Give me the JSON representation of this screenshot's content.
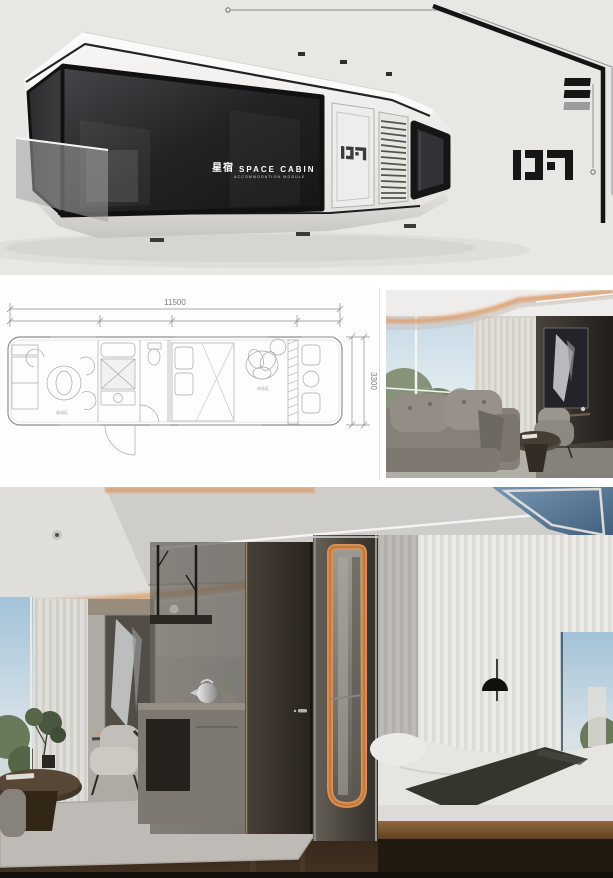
{
  "hero": {
    "bg_color": "#e9e7e4",
    "brand_cn": "星宿",
    "brand_en": "SPACE CABIN",
    "brand_sub": "ACCOMMODATION MODULE",
    "door_label": "D7",
    "corner_label": "D7"
  },
  "floor_plan": {
    "total_width": "11500",
    "depth": "3300",
    "zone_labels": [
      "休闲区",
      "休息区"
    ]
  },
  "colors": {
    "line_art": "#9a9a9a",
    "ink": "#161616",
    "warm_glow": "#e2a470",
    "copper_trim": "#c8803f",
    "sky": "#a8c8df",
    "wood_floor": "#3e2f1e"
  }
}
